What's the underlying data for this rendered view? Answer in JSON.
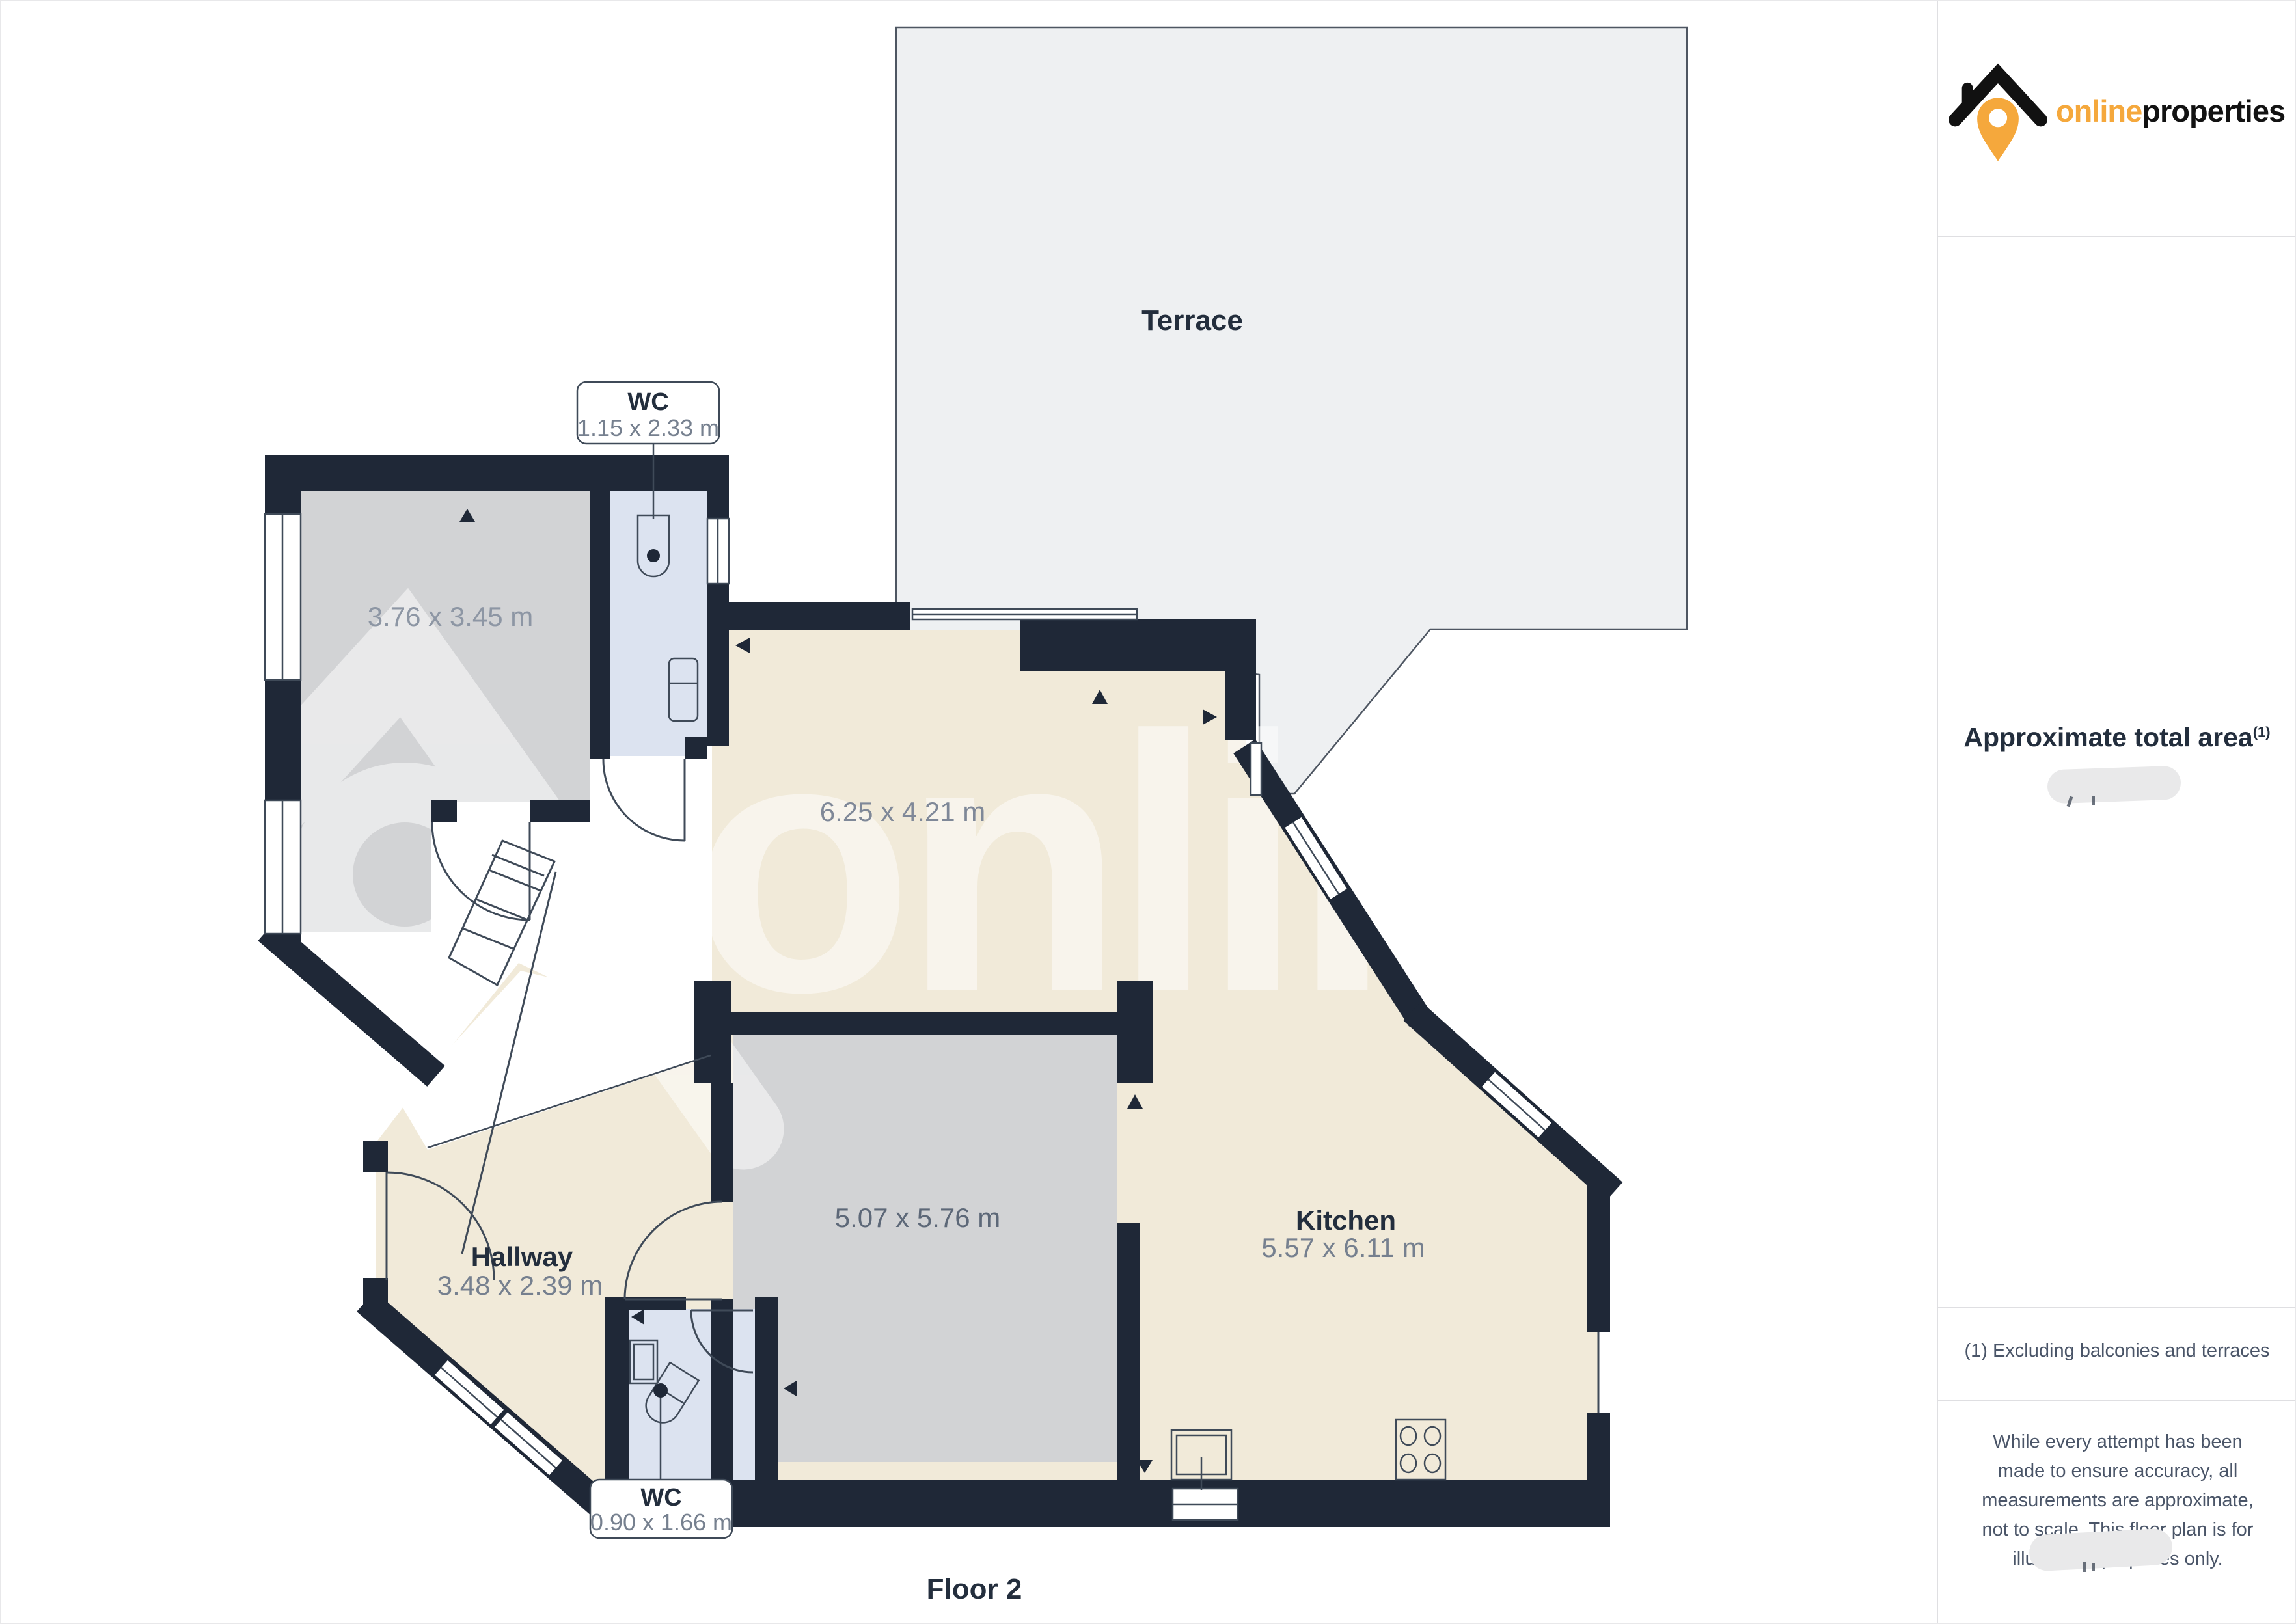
{
  "floorplan": {
    "floor_label": "Floor 2",
    "watermark_text": "onlinepro",
    "rooms": {
      "terrace": {
        "name": "Terrace"
      },
      "room_top_left": {
        "dims": "3.76 x 3.45 m"
      },
      "living": {
        "dims": "6.25 x 4.21 m"
      },
      "hallway": {
        "name": "Hallway",
        "dims": "3.48 x 2.39 m"
      },
      "room_center": {
        "dims": "5.07 x 5.76 m"
      },
      "kitchen": {
        "name": "Kitchen",
        "dims": "5.57 x 6.11 m"
      }
    },
    "callouts": {
      "wc_top": {
        "title": "WC",
        "dims": "1.15 x 2.33 m"
      },
      "wc_bottom": {
        "title": "WC",
        "dims": "0.90 x 1.66 m"
      }
    }
  },
  "sidebar": {
    "brand": {
      "name_online": "online",
      "name_properties": "properties"
    },
    "area_heading": "Approximate total area",
    "area_heading_superscript": "(1)",
    "footnote": "(1) Excluding balconies and terraces",
    "disclaimer": "While every attempt has been made to ensure accuracy, all measurements are approximate, not to scale. This floor plan is for illustrative purposes only."
  },
  "colors": {
    "wall_navy": "#1f2837",
    "cream": "#f1ead9",
    "room_gray": "#d2d3d5",
    "wc_blue": "#dce3f0",
    "terrace_gray": "#eef0f2",
    "label_navy": "#232e3d",
    "dim_text": "#76808f",
    "brand_orange": "#f5a83c"
  }
}
